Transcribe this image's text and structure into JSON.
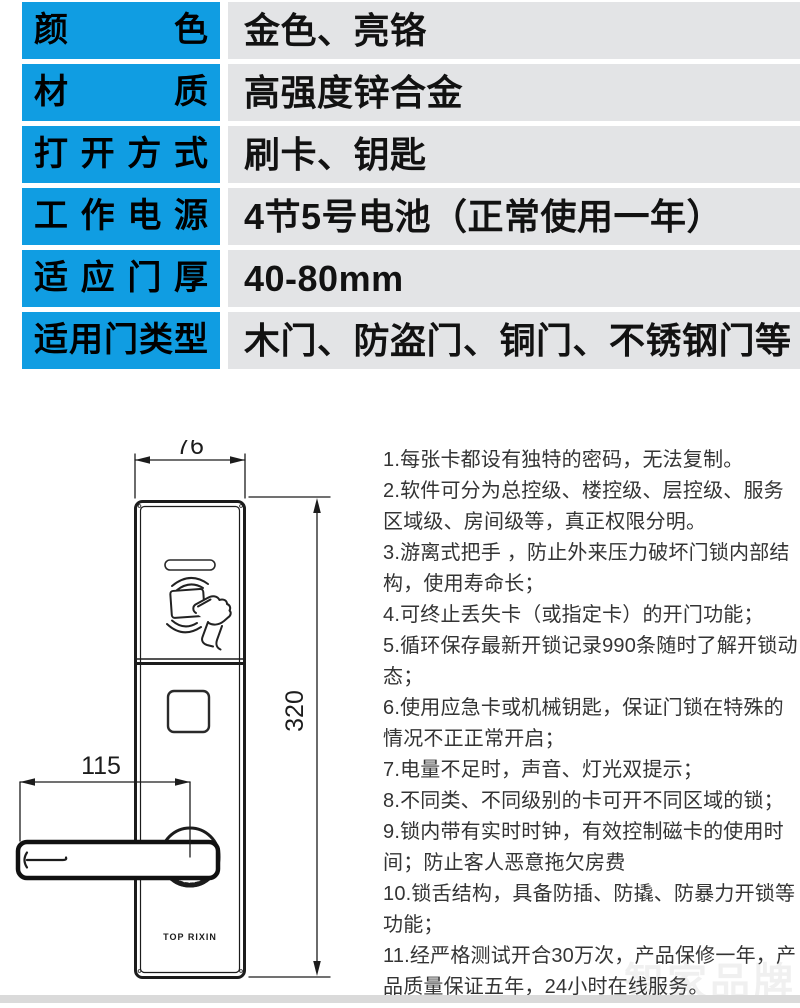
{
  "colors": {
    "accent_blue": "#109de2",
    "value_cell_gray": "#e3e4e6",
    "bottom_strip_gray": "#dadada",
    "drawing_line": "#1c1c1c"
  },
  "spec_table": {
    "rows": [
      {
        "label": "颜色",
        "value": "金色、亮铬"
      },
      {
        "label": "材质",
        "value": "高强度锌合金"
      },
      {
        "label": "打开方式",
        "value": "刷卡、钥匙"
      },
      {
        "label": "工作电源",
        "value": "4节5号电池（正常使用一年）"
      },
      {
        "label": "适应门厚",
        "value": "40-80mm"
      },
      {
        "label": "适用门类型",
        "value": "木门、防盗门、铜门、不锈钢门等"
      }
    ]
  },
  "diagram": {
    "width_dim": "76",
    "height_dim": "320",
    "handle_dim": "115",
    "brand_label": "TOP RIXIN"
  },
  "features": {
    "items": [
      "1.每张卡都设有独特的密码，无法复制。",
      "2.软件可分为总控级、楼控级、层控级、服务区域级、房间级等，真正权限分明。",
      "3.游离式把手 ，防止外来压力破坏门锁内部结构，使用寿命长；",
      "4.可终止丢失卡（或指定卡）的开门功能；",
      "5.循环保存最新开锁记录990条随时了解开锁动态；",
      "6.使用应急卡或机械钥匙，保证门锁在特殊的情况不正正常开启；",
      "7.电量不足时，声音、灯光双提示；",
      "8.不同类、不同级别的卡可开不同区域的锁；",
      "9.锁内带有实时时钟，有效控制磁卡的使用时间；防止客人恶意拖欠房费",
      "10.锁舌结构，具备防插、防撬、防暴力开锁等功能；",
      "11.经严格测试开合30万次，产品保修一年，产品质量保证五年，24小时在线服务。"
    ]
  },
  "watermark": {
    "text": "智家品牌"
  }
}
